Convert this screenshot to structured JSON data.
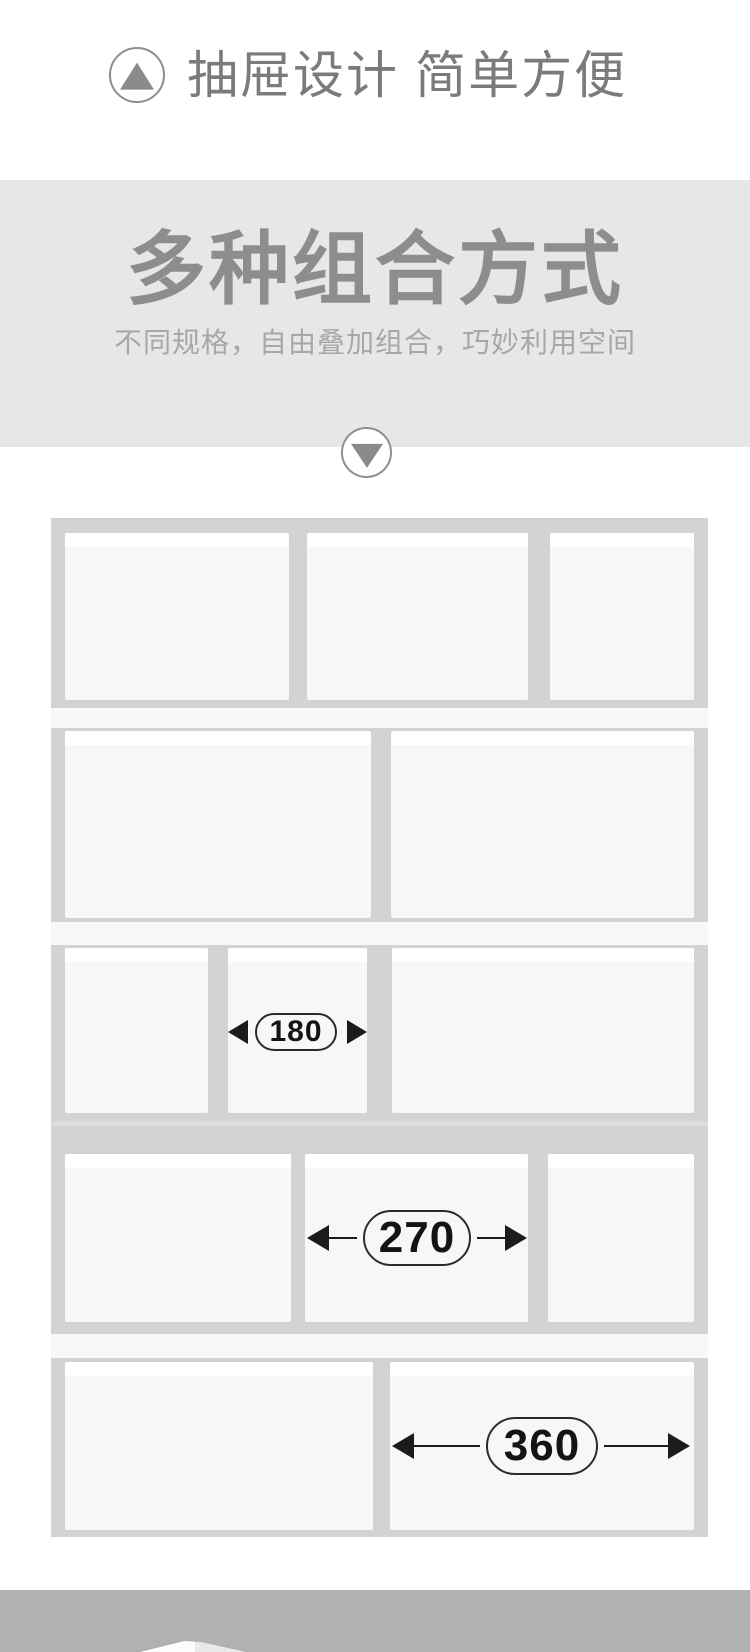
{
  "header": {
    "title": "抽屉设计 简单方便"
  },
  "band": {
    "title": "多种组合方式",
    "subtitle": "不同规格，自由叠加组合，巧妙利用空间"
  },
  "icons": {
    "up": "up-arrow-in-circle",
    "down": "down-arrow-in-circle"
  },
  "colors": {
    "band_bg": "#e7e7e7",
    "tray_bg": "#d3d3d5",
    "box_face": "#f7f7f7",
    "box_top": "#ffffff",
    "strip": "#f8f8f8",
    "footer_bg": "#b1b1b3",
    "text_gray": "#7b7b7b",
    "title_gray": "#8d8d8d",
    "subtitle_gray": "#a7a7a7",
    "dim_ink": "#1b1b1b"
  },
  "diagram": {
    "tray": {
      "x": 51,
      "y": 518,
      "w": 657,
      "h": 1019
    },
    "rows": [
      {
        "y": 533,
        "h": 167,
        "boxes": [
          {
            "x": 65,
            "w": 224
          },
          {
            "x": 307,
            "w": 221
          },
          {
            "x": 550,
            "w": 144
          }
        ]
      },
      {
        "y": 731,
        "h": 187,
        "boxes": [
          {
            "x": 65,
            "w": 306
          },
          {
            "x": 391,
            "w": 303
          }
        ]
      },
      {
        "y": 948,
        "h": 165,
        "boxes": [
          {
            "x": 65,
            "w": 143
          },
          {
            "x": 228,
            "w": 139
          },
          {
            "x": 392,
            "w": 302
          }
        ]
      },
      {
        "y": 1154,
        "h": 168,
        "boxes": [
          {
            "x": 65,
            "w": 226
          },
          {
            "x": 305,
            "w": 223
          },
          {
            "x": 548,
            "w": 146
          }
        ]
      },
      {
        "y": 1362,
        "h": 168,
        "boxes": [
          {
            "x": 65,
            "w": 308
          },
          {
            "x": 390,
            "w": 304
          }
        ]
      }
    ],
    "strips": [
      {
        "y": 708,
        "h": 20,
        "type": "light"
      },
      {
        "y": 922,
        "h": 23,
        "type": "light"
      },
      {
        "y": 1121,
        "h": 5,
        "type": "seam"
      },
      {
        "y": 1334,
        "h": 24,
        "type": "light"
      }
    ],
    "labels": [
      {
        "text": "180",
        "cx": 296,
        "cy": 1032,
        "pw": 82,
        "ph": 38,
        "fs": 30,
        "triW": 20,
        "triH": 12,
        "shaft": false,
        "x1": 228,
        "x2": 367
      },
      {
        "text": "270",
        "cx": 417,
        "cy": 1238,
        "pw": 108,
        "ph": 56,
        "fs": 44,
        "triW": 22,
        "triH": 13,
        "shaft": true,
        "x1": 307,
        "x2": 527
      },
      {
        "text": "360",
        "cx": 542,
        "cy": 1446,
        "pw": 112,
        "ph": 58,
        "fs": 44,
        "triW": 22,
        "triH": 13,
        "shaft": true,
        "x1": 392,
        "x2": 690
      }
    ]
  }
}
